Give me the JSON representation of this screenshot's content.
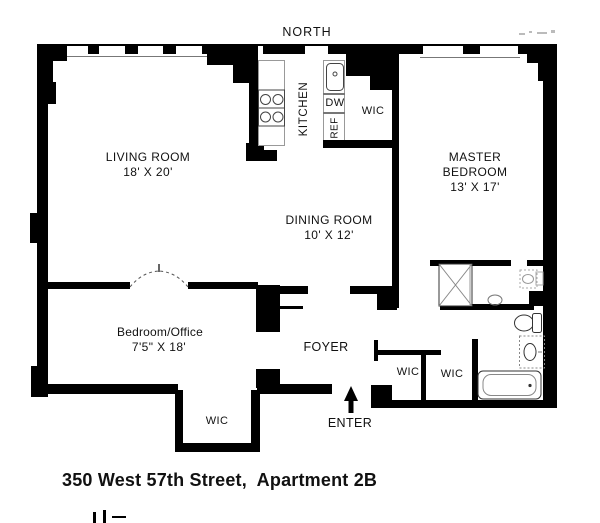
{
  "compass": {
    "north_label": "NORTH"
  },
  "rooms": {
    "living_room": {
      "name": "LIVING ROOM",
      "dimensions": "18' X 20'"
    },
    "dining_room": {
      "name": "DINING ROOM",
      "dimensions": "10' X 12'"
    },
    "master_bedroom": {
      "name_line1": "MASTER",
      "name_line2": "BEDROOM",
      "dimensions": "13' X 17'"
    },
    "bedroom_office": {
      "name": "Bedroom/Office",
      "dimensions": "7'5\" X 18'"
    },
    "kitchen": {
      "name": "KITCHEN"
    },
    "foyer": {
      "name": "FOYER"
    }
  },
  "closets": {
    "kitchen_wic": "WIC",
    "hall_wic_left": "WIC",
    "hall_wic_right": "WIC",
    "bottom_wic": "WIC"
  },
  "appliances": {
    "dishwasher": "DW",
    "refrigerator": "REF"
  },
  "entry": {
    "enter_label": "ENTER"
  },
  "footer": {
    "address_title": "350 West 57th Street,  Apartment 2B"
  },
  "colors": {
    "wall": "#000000",
    "background": "#ffffff",
    "fixture_line": "#555555",
    "text": "#111111"
  }
}
